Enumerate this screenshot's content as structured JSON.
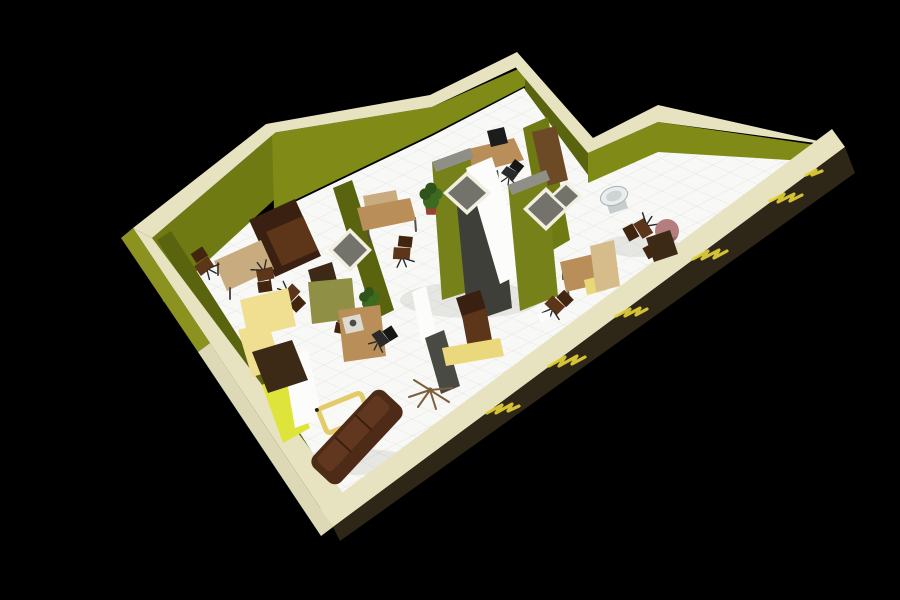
{
  "scene": {
    "title": "3D isometric office floor plan rendering",
    "background": "#eef0f2",
    "colors": {
      "wall_cap": "#e7e3c1",
      "wall_ext_sw": "#ddd8b5",
      "wall_ext_olive": "#8c921f",
      "wall_ext_dark": "#2e2617",
      "wall_olive_bright": "#7f8b16",
      "wall_olive_mid": "#6f7a12",
      "wall_olive_dark": "#5a630d",
      "partition_dark": "#4a4a44",
      "accent_yellow": "#dfe43b",
      "graffiti_yellow": "#e5d33a",
      "floor_white": "#f8f8f6",
      "tile_line": "#e4e4e1",
      "cabinet_olive": "#76811a",
      "cabinet_top_gray": "#8f8f88",
      "cabinet_dark": "#3f3f3a",
      "window_glass": "#73736c",
      "window_frame": "#f2efe0",
      "panel_white": "#fcfcfa",
      "desk_tan": "#b98e58",
      "desk_board": "#c8ab7e",
      "desk_yellow": "#f0df90",
      "tray_yellow": "#ecd87c",
      "sofa_brown": "#4e2b16",
      "chair_brown": "#5d3519",
      "chair_black": "#1e1e1e",
      "cabinet_brown": "#3d2a16",
      "plant_green": "#3c6a20",
      "pot_terracotta": "#9c4030",
      "sink_white": "#e9eded",
      "mauve_chair": "#b57e7e",
      "door_tan": "#d6bc8a",
      "door_brown": "#6d4a26",
      "table_frame_yellow": "#e3cb6a"
    },
    "objects": [
      {
        "name": "meeting-table",
        "label": "tan meeting table"
      },
      {
        "name": "office-chair",
        "label": "brown swivel office chair (x8)"
      },
      {
        "name": "armchair",
        "label": "large brown armchair"
      },
      {
        "name": "desk-yellow-l",
        "label": "pale yellow L-shaped desk"
      },
      {
        "name": "cabinet-brown",
        "label": "dark brown low cabinet"
      },
      {
        "name": "desk-computer",
        "label": "desk with monitor"
      },
      {
        "name": "desk-side",
        "label": "desk with back board"
      },
      {
        "name": "cabinet-tall",
        "label": "tall olive cabinets (x2)"
      },
      {
        "name": "wall-window",
        "label": "white framed window (x4)"
      },
      {
        "name": "white-panel",
        "label": "white leaning door panel"
      },
      {
        "name": "door-brown",
        "label": "brown leaning door"
      },
      {
        "name": "plant",
        "label": "potted plant (x2)"
      },
      {
        "name": "l-desk-olive",
        "label": "olive/tan corner workstation"
      },
      {
        "name": "chair-black",
        "label": "black office chair (x3)"
      },
      {
        "name": "partition",
        "label": "dark privacy partition"
      },
      {
        "name": "coat-rack",
        "label": "standing coat rack"
      },
      {
        "name": "coffee-table",
        "label": "yellow frame glass coffee table"
      },
      {
        "name": "sofa",
        "label": "brown three-seat sofa"
      },
      {
        "name": "recliner",
        "label": "brown recliner chair with yellow tray"
      },
      {
        "name": "desk-right",
        "label": "desk near open door"
      },
      {
        "name": "door-open",
        "label": "open wooden door"
      },
      {
        "name": "sink",
        "label": "white wash basin"
      },
      {
        "name": "mauve-chair",
        "label": "mauve round chair"
      },
      {
        "name": "graffiti",
        "label": "yellow graffiti on dark exterior wall"
      },
      {
        "name": "accent-wall",
        "label": "bright yellow accent wall corner"
      }
    ]
  }
}
